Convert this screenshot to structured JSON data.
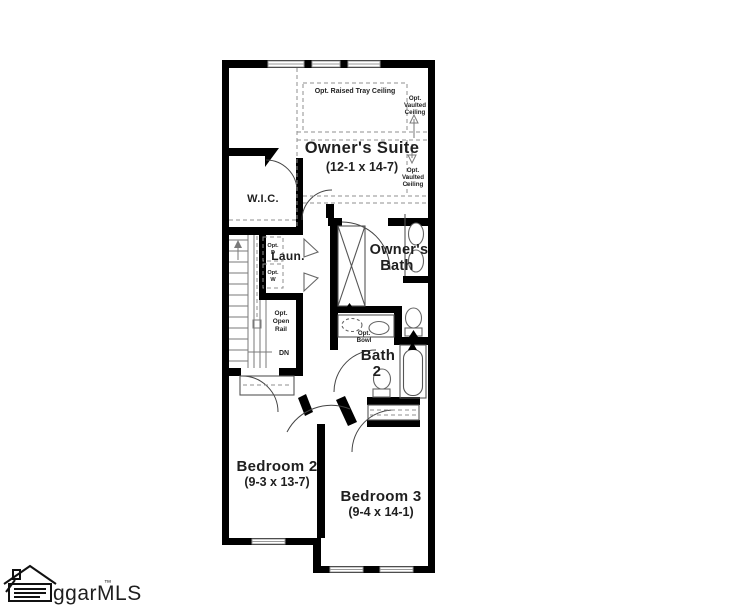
{
  "title": "Second floor plan",
  "watermark": {
    "text": "ggarMLS",
    "tm": "™"
  },
  "rooms": {
    "owners_suite": {
      "name": "Owner's Suite",
      "dims": "(12-1 x 14-7)"
    },
    "wic": {
      "name": "W.I.C."
    },
    "laundry": {
      "name": "Laun."
    },
    "owners_bath": {
      "lines": [
        "Owner's",
        "Bath"
      ]
    },
    "bath2": {
      "lines": [
        "Bath",
        "2"
      ]
    },
    "bedroom2": {
      "name": "Bedroom 2",
      "dims": "(9-3 x 13-7)"
    },
    "bedroom3": {
      "name": "Bedroom 3",
      "dims": "(9-4 x 14-1)"
    }
  },
  "annotations": {
    "tray_ceiling": "Opt. Raised Tray Ceiling",
    "vaulted_upper": [
      "Opt.",
      "Vaulted",
      "Ceiling"
    ],
    "vaulted_lower": [
      "Opt.",
      "Vaulted",
      "Ceiling"
    ],
    "open_rail": [
      "Opt.",
      "Open",
      "Rail"
    ],
    "down": "DN",
    "opt_dryer": [
      "Opt.",
      "D"
    ],
    "opt_washer": [
      "Opt.",
      "W"
    ],
    "opt_bowl": [
      "Opt.",
      "Bowl"
    ]
  },
  "icons": {
    "house_logo": "house-with-document-and-pencil",
    "fixtures": [
      "shower",
      "toilet",
      "double-sink-vanity",
      "bathtub",
      "stairs",
      "windows",
      "door-arcs"
    ]
  },
  "colors": {
    "wall": "#000000",
    "text": "#1f1f1f",
    "fixture_outline": "#666666",
    "dashed_line": "#8f8f8f",
    "window": "#9a9a9a",
    "background": "#ffffff"
  }
}
